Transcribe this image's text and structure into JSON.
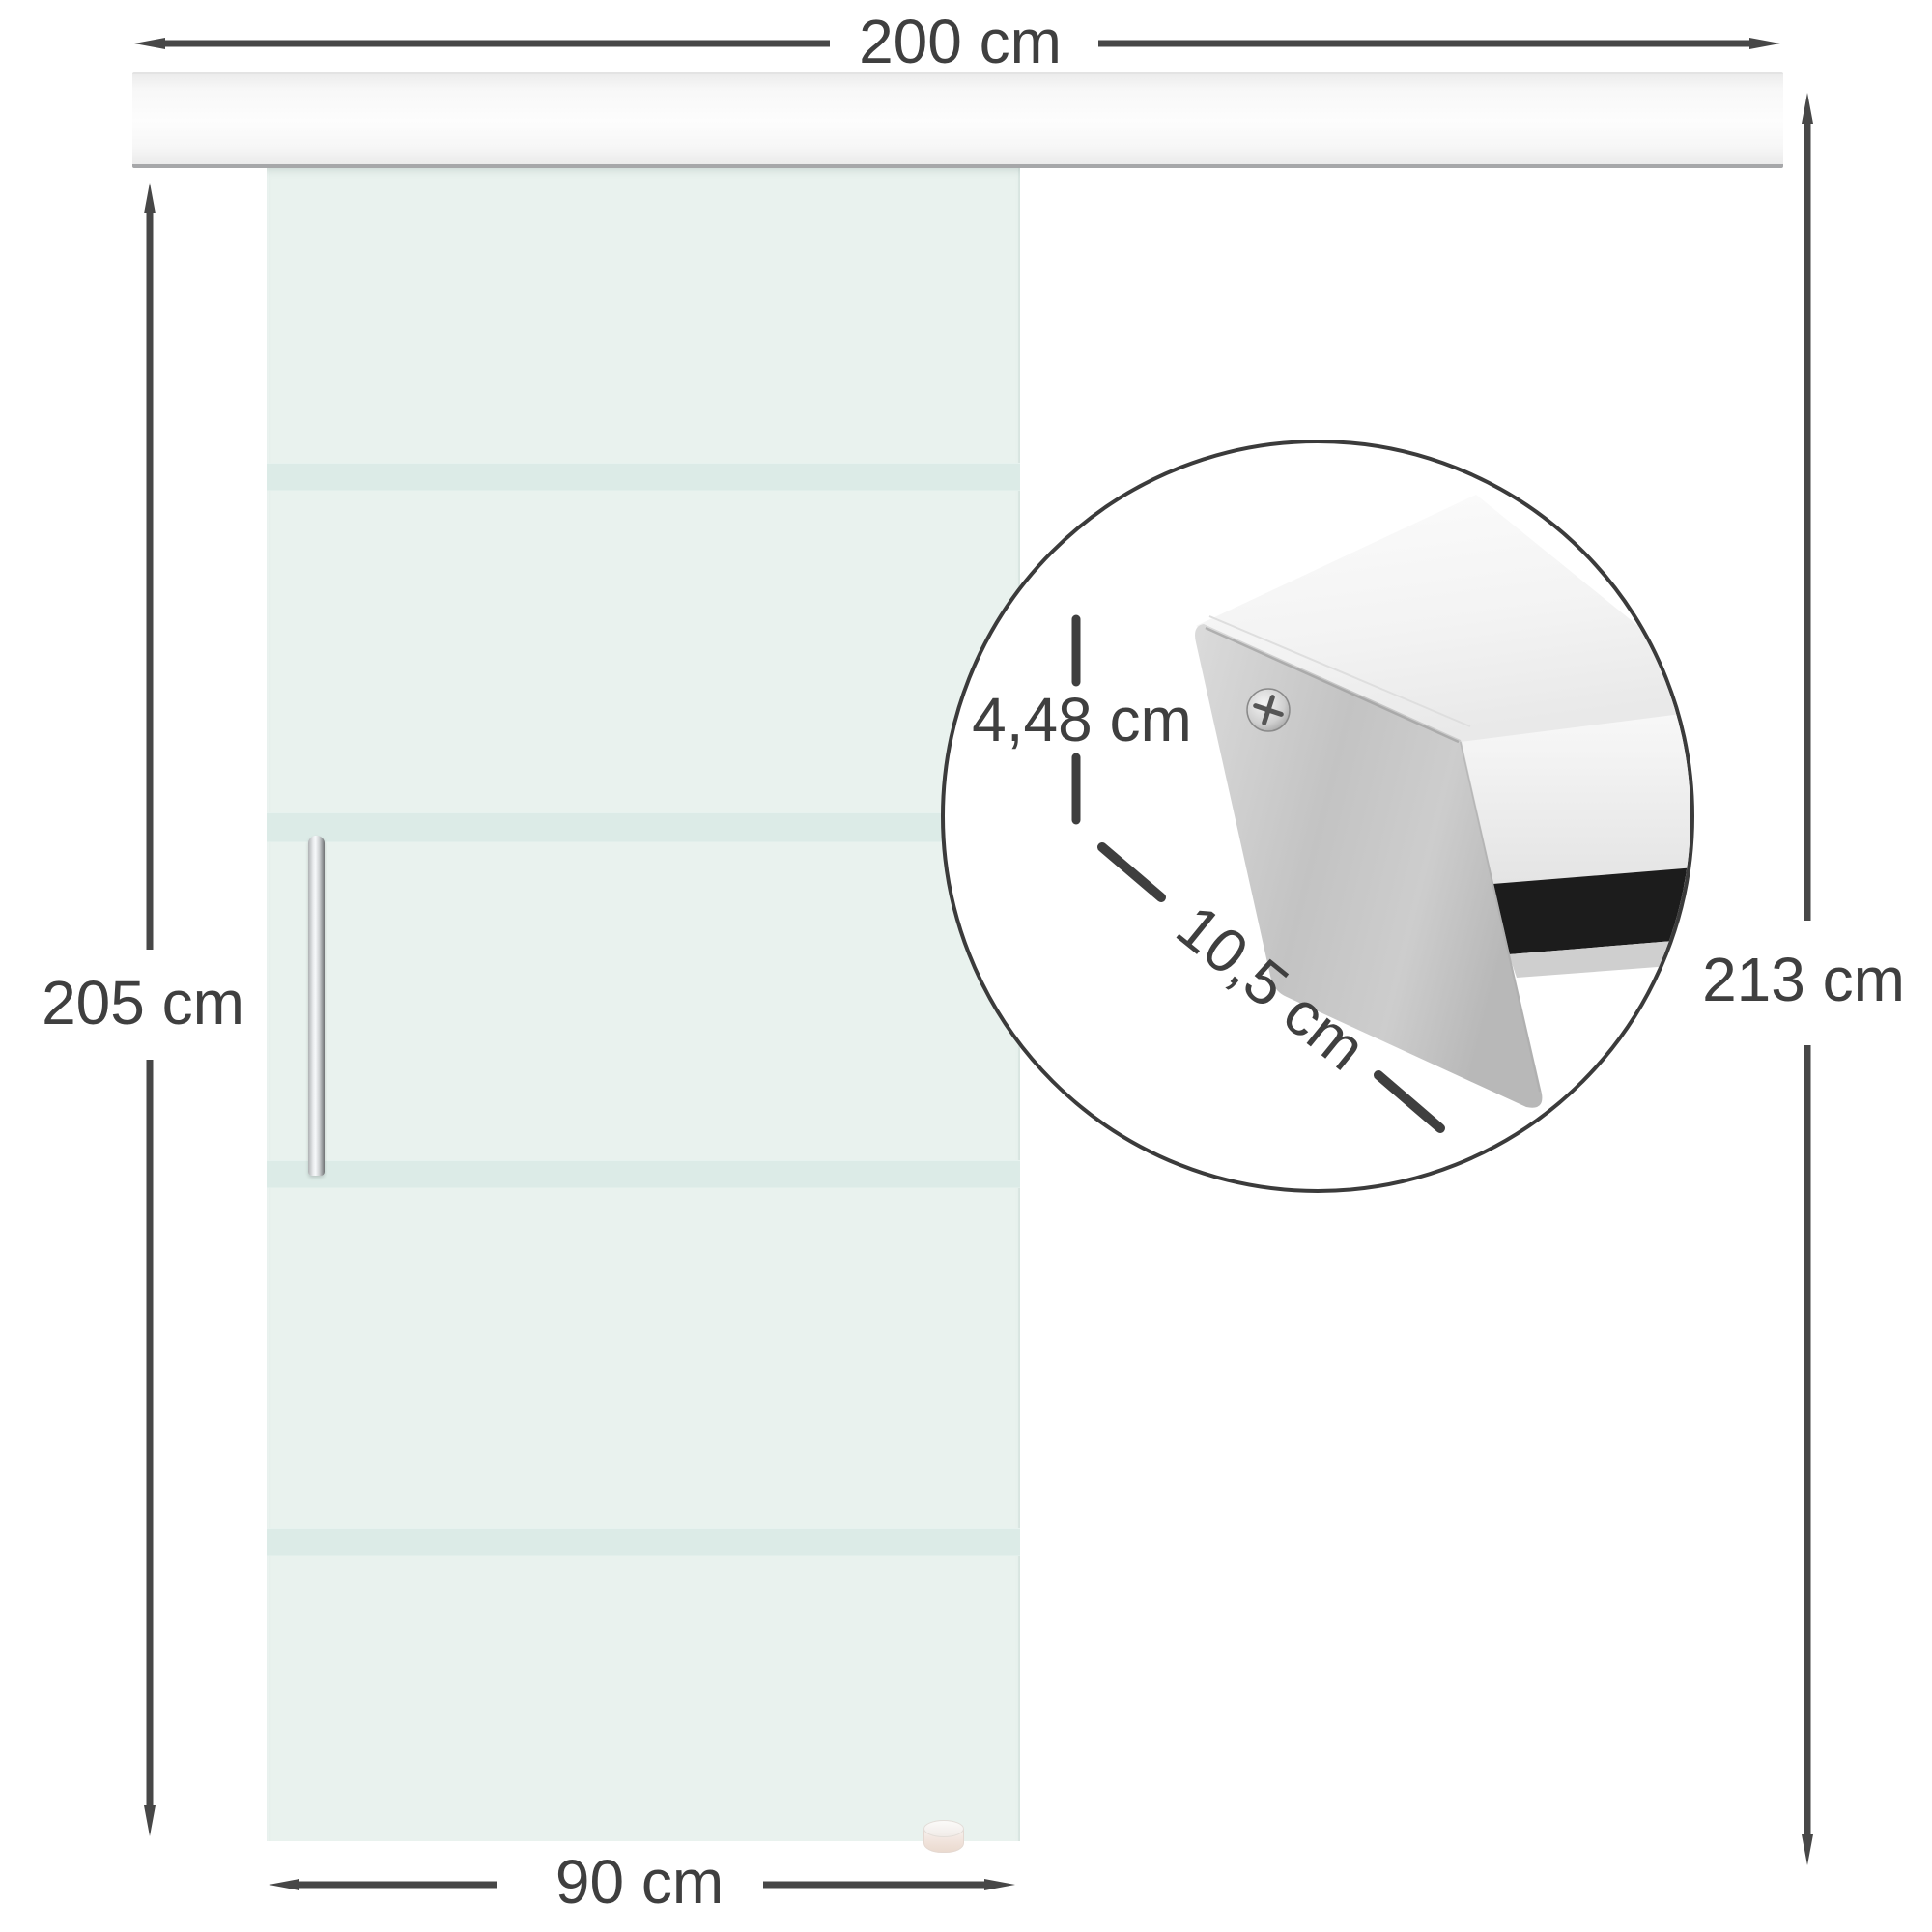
{
  "labels": {
    "track_width": "200 cm",
    "door_height": "205 cm",
    "total_height": "213 cm",
    "door_width": "90 cm"
  },
  "detail": {
    "profile_height": "4,48 cm",
    "profile_depth": "10,5 cm"
  },
  "colors": {
    "dimension_line": "#474747",
    "label_text": "#3f3f3f",
    "glass_tint": "#e9f2ee",
    "glass_stripe": "#dcebe7",
    "rail_metal": "#f7f7f7",
    "rail_edge": "#a6a7a9",
    "circle_border": "#3b3b3b",
    "cap_metal": "#c6c6c6",
    "slot_dark": "#1c1c1c"
  }
}
